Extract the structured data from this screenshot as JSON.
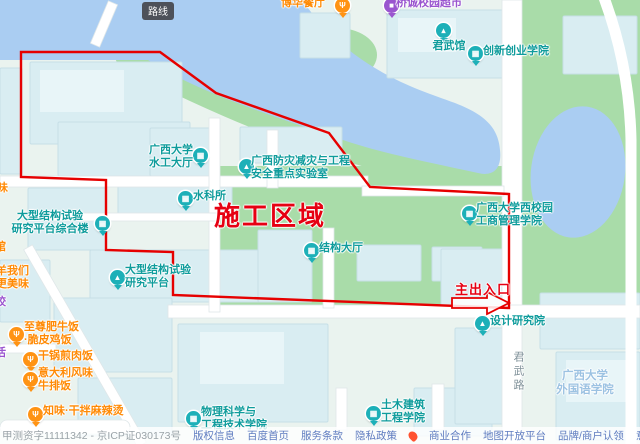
{
  "map": {
    "tooltip": "路线",
    "construction_label": "施工区域",
    "entrance_label": "主出入口",
    "colors": {
      "annotation_red": "#e60012",
      "outline_red": "#e60000",
      "water": "#aacdf2",
      "green": "#a9dca9",
      "building": "#d9edf2",
      "road": "#ffffff",
      "poi_teal": "#0f9c9c",
      "poi_food_orange": "#ff8a05",
      "poi_shop_purple": "#9a55cf",
      "area_blue": "#9cc2e2"
    },
    "pois": [
      {
        "id": "poi-shuigong-dating",
        "type": "inst",
        "text": "广西大学\n水工大厅",
        "x": 144,
        "y": 144,
        "w": 54,
        "center": true,
        "pin": {
          "x": 193,
          "y": 148,
          "glyph": "▦",
          "icon": "building"
        }
      },
      {
        "id": "poi-fangzai-lab",
        "type": "inst",
        "text": "广西防灾减灾与工程\n安全重点实验室",
        "x": 251,
        "y": 155,
        "pin": {
          "x": 239,
          "y": 159,
          "glyph": "▲",
          "icon": "lab-building"
        }
      },
      {
        "id": "poi-shuikesuo",
        "type": "inst",
        "text": "水科所",
        "x": 193,
        "y": 190,
        "pin": {
          "x": 178,
          "y": 191,
          "glyph": "▦",
          "icon": "building"
        }
      },
      {
        "id": "poi-jiegou-dating",
        "type": "inst",
        "text": "结构大厅",
        "x": 319,
        "y": 242,
        "pin": {
          "x": 304,
          "y": 243,
          "glyph": "▦",
          "icon": "building"
        }
      },
      {
        "id": "poi-zonghelou",
        "type": "inst",
        "text": "大型结构试验\n研究平台综合楼",
        "x": 4,
        "y": 210,
        "w": 92,
        "center": true,
        "pin": {
          "x": 95,
          "y": 216,
          "glyph": "▦",
          "icon": "building"
        }
      },
      {
        "id": "poi-yanjiu-pingtai",
        "type": "inst",
        "text": "大型结构试验\n研究平台",
        "x": 125,
        "y": 264,
        "pin": {
          "x": 110,
          "y": 270,
          "glyph": "▲",
          "icon": "lab-building"
        }
      },
      {
        "id": "poi-gongshang",
        "type": "inst",
        "text": "广西大学西校园\n工商管理学院",
        "x": 476,
        "y": 202,
        "pin": {
          "x": 462,
          "y": 206,
          "glyph": "▦",
          "icon": "building"
        }
      },
      {
        "id": "poi-sheji-yuan",
        "type": "inst",
        "text": "设计研究院",
        "x": 490,
        "y": 315,
        "pin": {
          "x": 475,
          "y": 316,
          "glyph": "▲",
          "icon": "design-institute"
        }
      },
      {
        "id": "poi-wuli-xueyuan",
        "type": "inst",
        "text": "物理科学与\n工程技术学院",
        "x": 201,
        "y": 406,
        "pin": {
          "x": 186,
          "y": 411,
          "glyph": "▦",
          "icon": "building"
        }
      },
      {
        "id": "poi-tumu-xueyuan",
        "type": "inst",
        "text": "土木建筑\n工程学院",
        "x": 381,
        "y": 399,
        "pin": {
          "x": 366,
          "y": 406,
          "glyph": "▦",
          "icon": "building"
        }
      },
      {
        "id": "poi-junwuguan",
        "type": "inst",
        "text": "君武馆",
        "x": 425,
        "y": 40,
        "w": 48,
        "center": true,
        "pin": {
          "x": 436,
          "y": 23,
          "glyph": "▴",
          "icon": "school-cap"
        }
      },
      {
        "id": "poi-chuangxin-xueyuan",
        "type": "inst",
        "text": "创新创业学院",
        "x": 483,
        "y": 45,
        "pin": {
          "x": 468,
          "y": 46,
          "glyph": "▦",
          "icon": "building"
        }
      },
      {
        "id": "poi-bohua-canting",
        "type": "food",
        "text": "博华餐厅",
        "x": 281,
        "y": -3,
        "pin": {
          "x": 335,
          "y": -2,
          "glyph": "Ψ",
          "icon": "restaurant"
        }
      },
      {
        "id": "poi-xiaoyuan-chaoshi",
        "type": "shop",
        "text": "桥诚校园超市",
        "x": 396,
        "y": -3,
        "pin": {
          "x": 384,
          "y": -2,
          "glyph": "■",
          "icon": "shop"
        }
      },
      {
        "id": "poi-zhizun-niufan",
        "type": "food",
        "text": "至尊肥牛饭\n·脆皮鸡饭",
        "x": 24,
        "y": 321,
        "pin": {
          "x": 9,
          "y": 327,
          "glyph": "Ψ",
          "icon": "restaurant"
        }
      },
      {
        "id": "poi-ganguo-jianroufan",
        "type": "food",
        "text": "干锅煎肉饭",
        "x": 38,
        "y": 350,
        "pin": {
          "x": 23,
          "y": 352,
          "glyph": "Ψ",
          "icon": "restaurant"
        }
      },
      {
        "id": "poi-yidali-niupaifan",
        "type": "food",
        "text": "意大利风味\n牛排饭",
        "x": 38,
        "y": 367,
        "pin": {
          "x": 23,
          "y": 372,
          "glyph": "Ψ",
          "icon": "restaurant"
        }
      },
      {
        "id": "poi-zhiwei-malatang",
        "type": "food",
        "text": "知味·干拌麻辣烫",
        "x": 43,
        "y": 405,
        "pin": {
          "x": 28,
          "y": 407,
          "glyph": "Ψ",
          "icon": "restaurant"
        }
      },
      {
        "id": "area-waiguoyu-xueyuan",
        "type": "area",
        "text": "广西大学\n外国语学院",
        "x": 554,
        "y": 370,
        "w": 62,
        "center": true,
        "interactable": false
      },
      {
        "id": "road-label-junwulu",
        "type": "roadv",
        "text": "君武路",
        "x": 511,
        "y": 351,
        "interactable": false
      },
      {
        "id": "poi-partial-guiwei",
        "type": "food",
        "text": "桂味",
        "x": -14,
        "y": 182
      },
      {
        "id": "poi-partial-guan",
        "type": "food",
        "text": "馆",
        "x": -5,
        "y": 241
      },
      {
        "id": "poi-partial-yang",
        "type": "food",
        "text": "羊我们\n更美味",
        "x": -4,
        "y": 265
      },
      {
        "id": "poi-partial-shop1",
        "type": "shop",
        "text": "饺",
        "x": -5,
        "y": 296
      },
      {
        "id": "poi-partial-shop2",
        "type": "shop",
        "text": "活",
        "x": -5,
        "y": 347
      }
    ]
  },
  "footer": {
    "items": [
      {
        "label": "甲测资字11111342 - 京ICP证030173号",
        "cls": "icp"
      },
      {
        "label": "版权信息"
      },
      {
        "label": "百度首页"
      },
      {
        "label": "服务条款"
      },
      {
        "label": "隐私政策"
      },
      {
        "icon": "flame-icon"
      },
      {
        "label": "商业合作"
      },
      {
        "label": "地图开放平台"
      },
      {
        "label": "品牌/商户认领"
      },
      {
        "label": "意见建议"
      },
      {
        "label": "下载地图客户端"
      },
      {
        "icon": "app-icon"
      },
      {
        "label": "新增地点"
      },
      {
        "label": "百度首页"
      }
    ]
  }
}
